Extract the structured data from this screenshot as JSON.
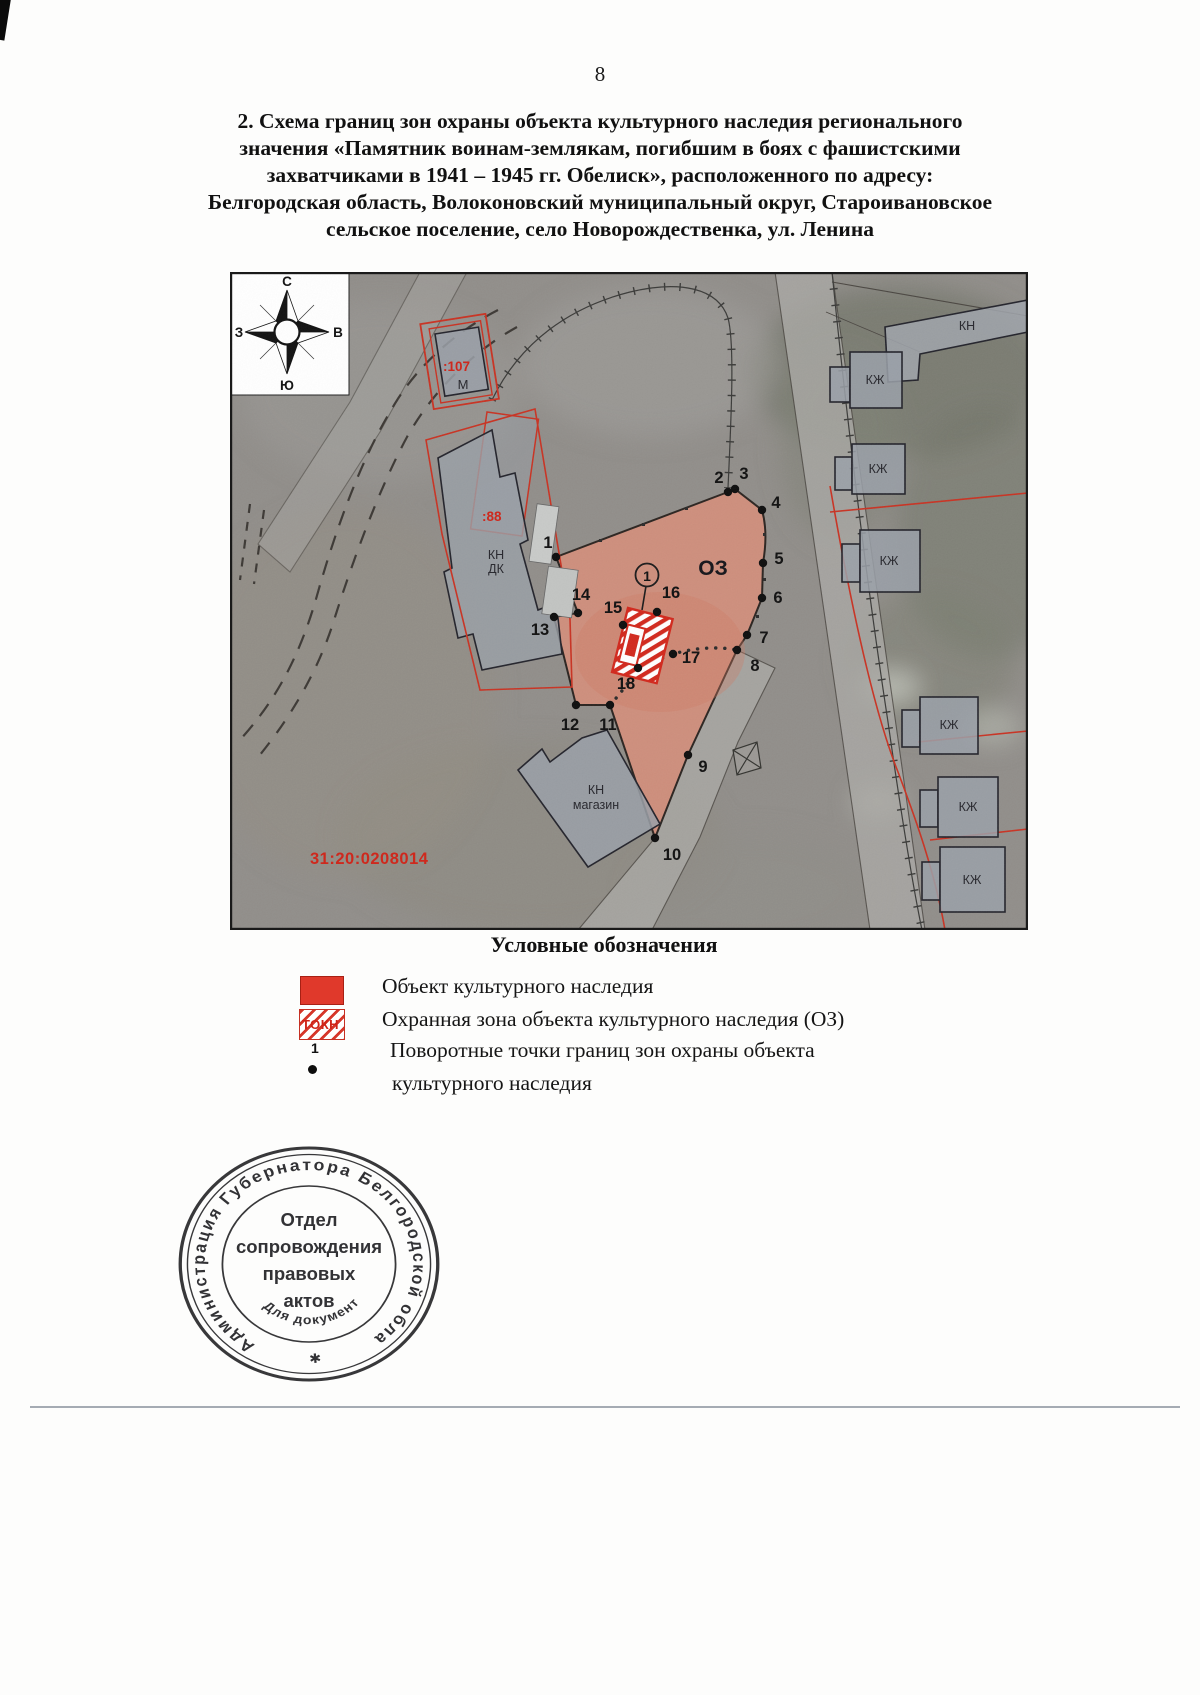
{
  "page": {
    "number": "8",
    "title_lines": [
      "2. Схема границ зон охраны объекта культурного наследия регионального",
      "значения «Памятник воинам-землякам, погибшим в боях с фашистскими",
      "захватчиками в 1941 – 1945 гг. Обелиск», расположенного по адресу:",
      "Белгородская область, Волоконовский муниципальный округ, Староивановское",
      "сельское поселение, село Новорождественка, ул. Ленина"
    ]
  },
  "map": {
    "compass": {
      "north": "С",
      "south": "Ю",
      "west": "З",
      "east": "В"
    },
    "labels": {
      "zone": "ОЗ",
      "cadastral_quarter": "31:20:0208014",
      "parcel_107": ":107",
      "building_m": "М",
      "parcel_88": ":88",
      "dk_line1": "КН",
      "dk_line2": "ДК",
      "shop_line1": "КН",
      "shop_line2": "магазин",
      "kn": "КН",
      "kzh": "КЖ",
      "monument_point": "1"
    },
    "turning_points": [
      "1",
      "2",
      "3",
      "4",
      "5",
      "6",
      "7",
      "8",
      "9",
      "10",
      "11",
      "12",
      "13",
      "14",
      "15",
      "16",
      "17",
      "18"
    ]
  },
  "legend": {
    "title": "Условные обозначения",
    "items": [
      {
        "symbol": "red-fill",
        "label": "Объект культурного наследия"
      },
      {
        "symbol": "red-hatch",
        "symbol_text": "ТОКН",
        "label": "Охранная зона объекта культурного наследия (ОЗ)"
      },
      {
        "symbol": "turning-point",
        "symbol_number": "1",
        "label_line1": "Поворотные точки границ зон охраны объекта",
        "label_line2": "культурного наследия"
      }
    ]
  },
  "stamp": {
    "ring_text": "Администрация Губернатора Белгородской области",
    "bottom_text": "Для документов",
    "center_lines": [
      "Отдел",
      "сопровождения",
      "правовых",
      "актов"
    ],
    "star": "✱"
  },
  "colors": {
    "accent_red": "#cc2b1e",
    "zone_fill": "#dd8f79",
    "building_fill": "#979ca6"
  }
}
